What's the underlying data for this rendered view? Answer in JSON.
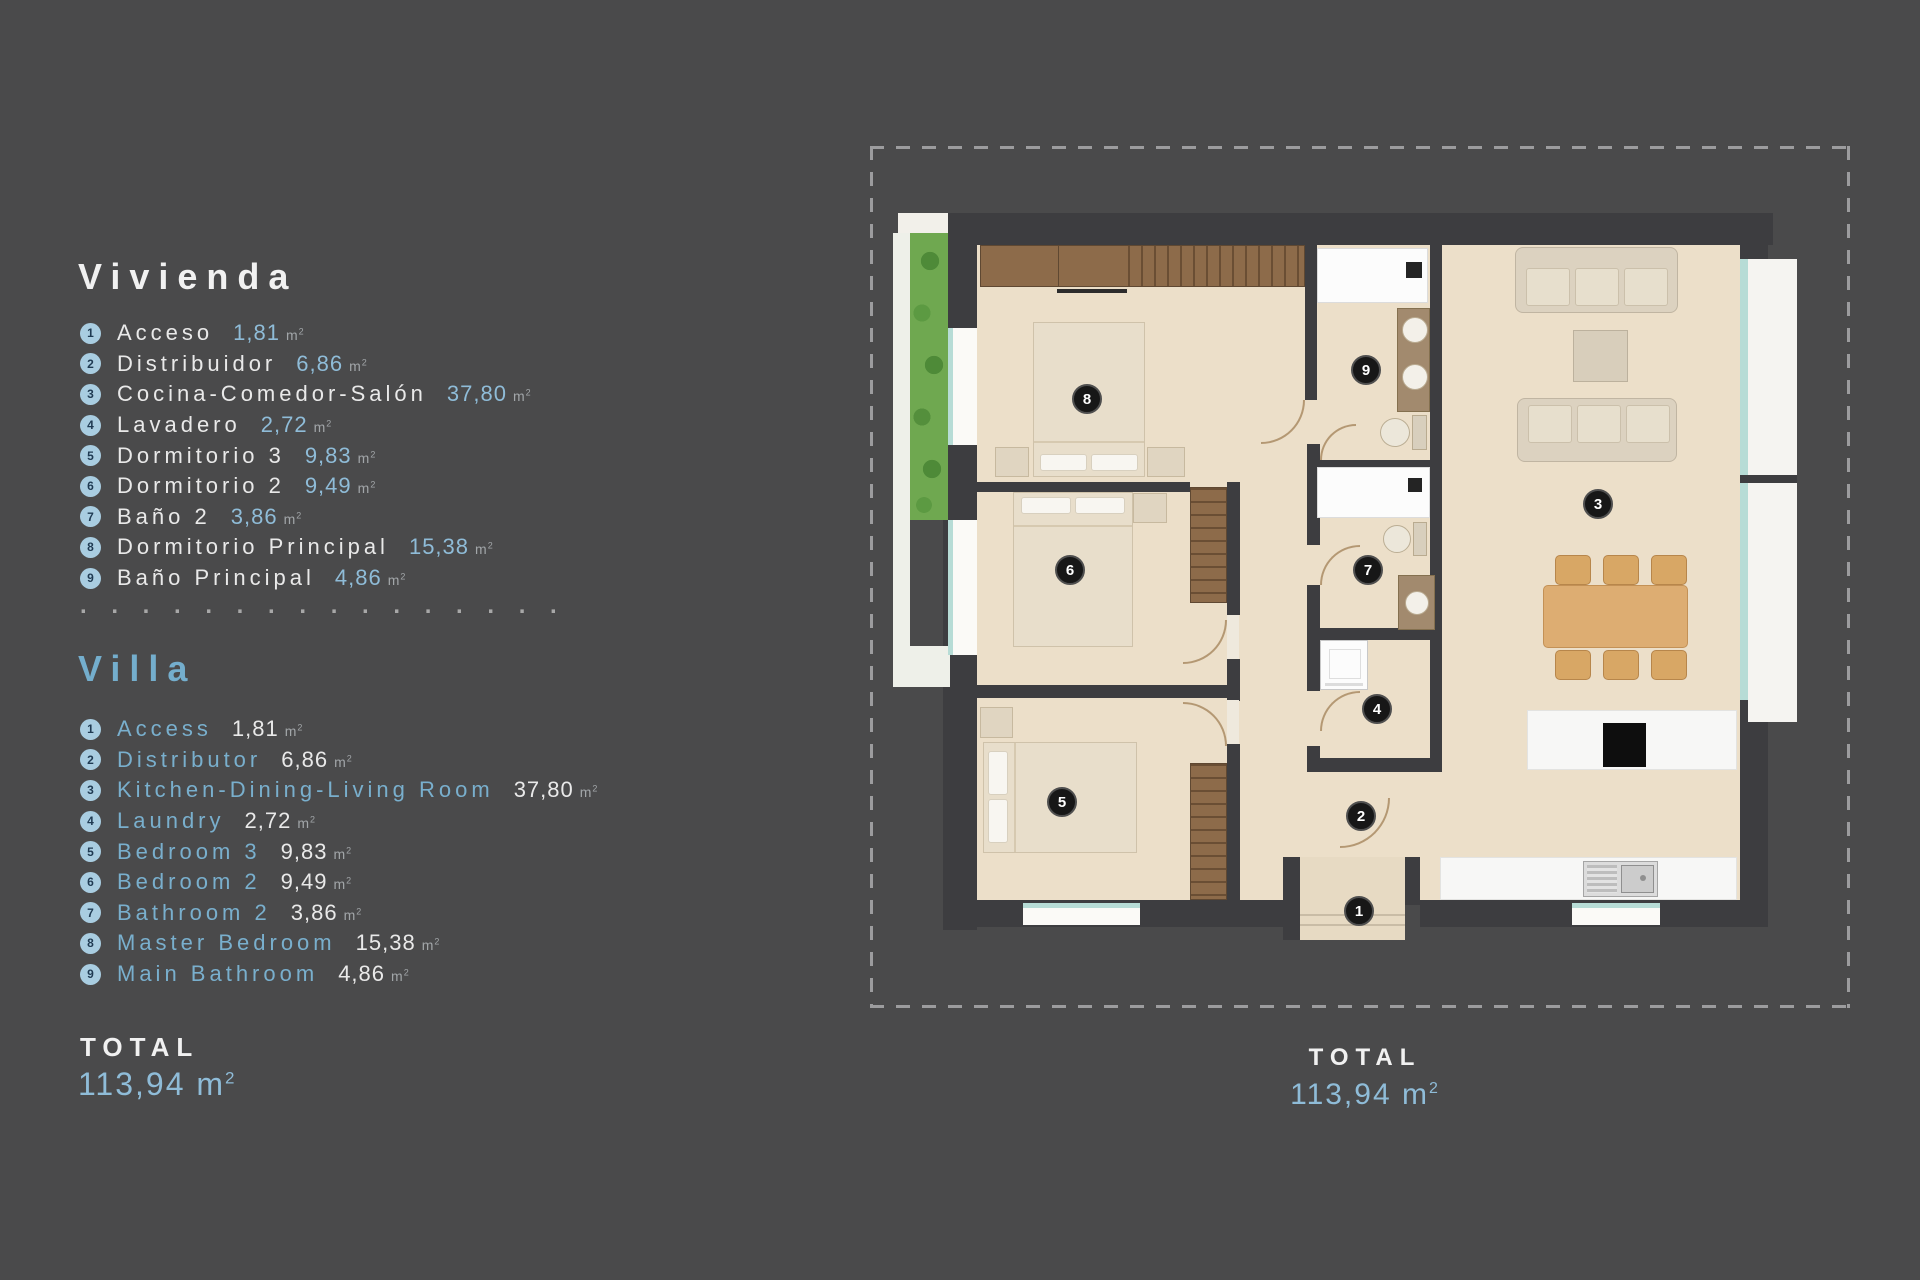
{
  "colors": {
    "background": "#4a4a4b",
    "accent_blue": "#8fbcd8",
    "badge_blue": "#a9cde1",
    "wall": "#3d3d40",
    "floor": "#ecdfc9"
  },
  "legend": {
    "unit": "m",
    "unit_sup": "2",
    "separator": ". . . . . . . . . . . . . . . .",
    "total_label": "TOTAL",
    "total_value": "113,94",
    "sections": [
      {
        "id": "vivienda",
        "title": "Vivienda",
        "items": [
          {
            "num": "1",
            "name": "Acceso",
            "area": "1,81"
          },
          {
            "num": "2",
            "name": "Distribuidor",
            "area": "6,86"
          },
          {
            "num": "3",
            "name": "Cocina-Comedor-Salón",
            "area": "37,80"
          },
          {
            "num": "4",
            "name": "Lavadero",
            "area": "2,72"
          },
          {
            "num": "5",
            "name": "Dormitorio 3",
            "area": "9,83"
          },
          {
            "num": "6",
            "name": "Dormitorio 2",
            "area": "9,49"
          },
          {
            "num": "7",
            "name": "Baño 2",
            "area": "3,86"
          },
          {
            "num": "8",
            "name": "Dormitorio Principal",
            "area": "15,38"
          },
          {
            "num": "9",
            "name": "Baño Principal",
            "area": "4,86"
          }
        ]
      },
      {
        "id": "villa",
        "title": "Villa",
        "items": [
          {
            "num": "1",
            "name": "Access",
            "area": "1,81"
          },
          {
            "num": "2",
            "name": "Distributor",
            "area": "6,86"
          },
          {
            "num": "3",
            "name": "Kitchen-Dining-Living Room",
            "area": "37,80"
          },
          {
            "num": "4",
            "name": "Laundry",
            "area": "2,72"
          },
          {
            "num": "5",
            "name": "Bedroom 3",
            "area": "9,83"
          },
          {
            "num": "6",
            "name": "Bedroom 2",
            "area": "9,49"
          },
          {
            "num": "7",
            "name": "Bathroom 2",
            "area": "3,86"
          },
          {
            "num": "8",
            "name": "Master Bedroom",
            "area": "15,38"
          },
          {
            "num": "9",
            "name": "Main Bathroom",
            "area": "4,86"
          }
        ]
      }
    ]
  },
  "plan": {
    "total_label": "TOTAL",
    "total_value": "113,94",
    "markers": [
      {
        "label": "1",
        "x": 489,
        "y": 765
      },
      {
        "label": "2",
        "x": 491,
        "y": 670
      },
      {
        "label": "3",
        "x": 728,
        "y": 358
      },
      {
        "label": "4",
        "x": 507,
        "y": 563
      },
      {
        "label": "5",
        "x": 192,
        "y": 656
      },
      {
        "label": "6",
        "x": 200,
        "y": 424
      },
      {
        "label": "7",
        "x": 498,
        "y": 424
      },
      {
        "label": "8",
        "x": 217,
        "y": 253
      },
      {
        "label": "9",
        "x": 496,
        "y": 224
      }
    ]
  }
}
